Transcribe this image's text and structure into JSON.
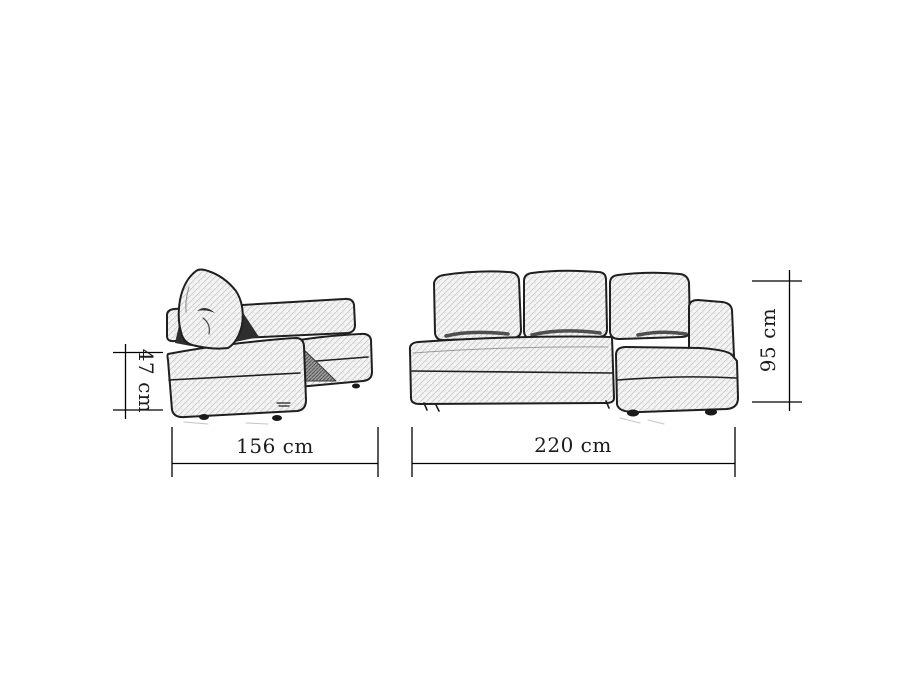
{
  "diagram": {
    "side_view": {
      "height_label": "47 cm",
      "width_label": "156 cm"
    },
    "front_view": {
      "height_label": "95 cm",
      "width_label": "220 cm"
    }
  },
  "colors": {
    "background": "#ffffff",
    "outline": "#1f1f1f",
    "dimension_line": "#000000",
    "hatch_light": "#c9c9c9",
    "shadow_gray": "#8f8f8f",
    "shadow_dark": "#2e2e2e"
  }
}
